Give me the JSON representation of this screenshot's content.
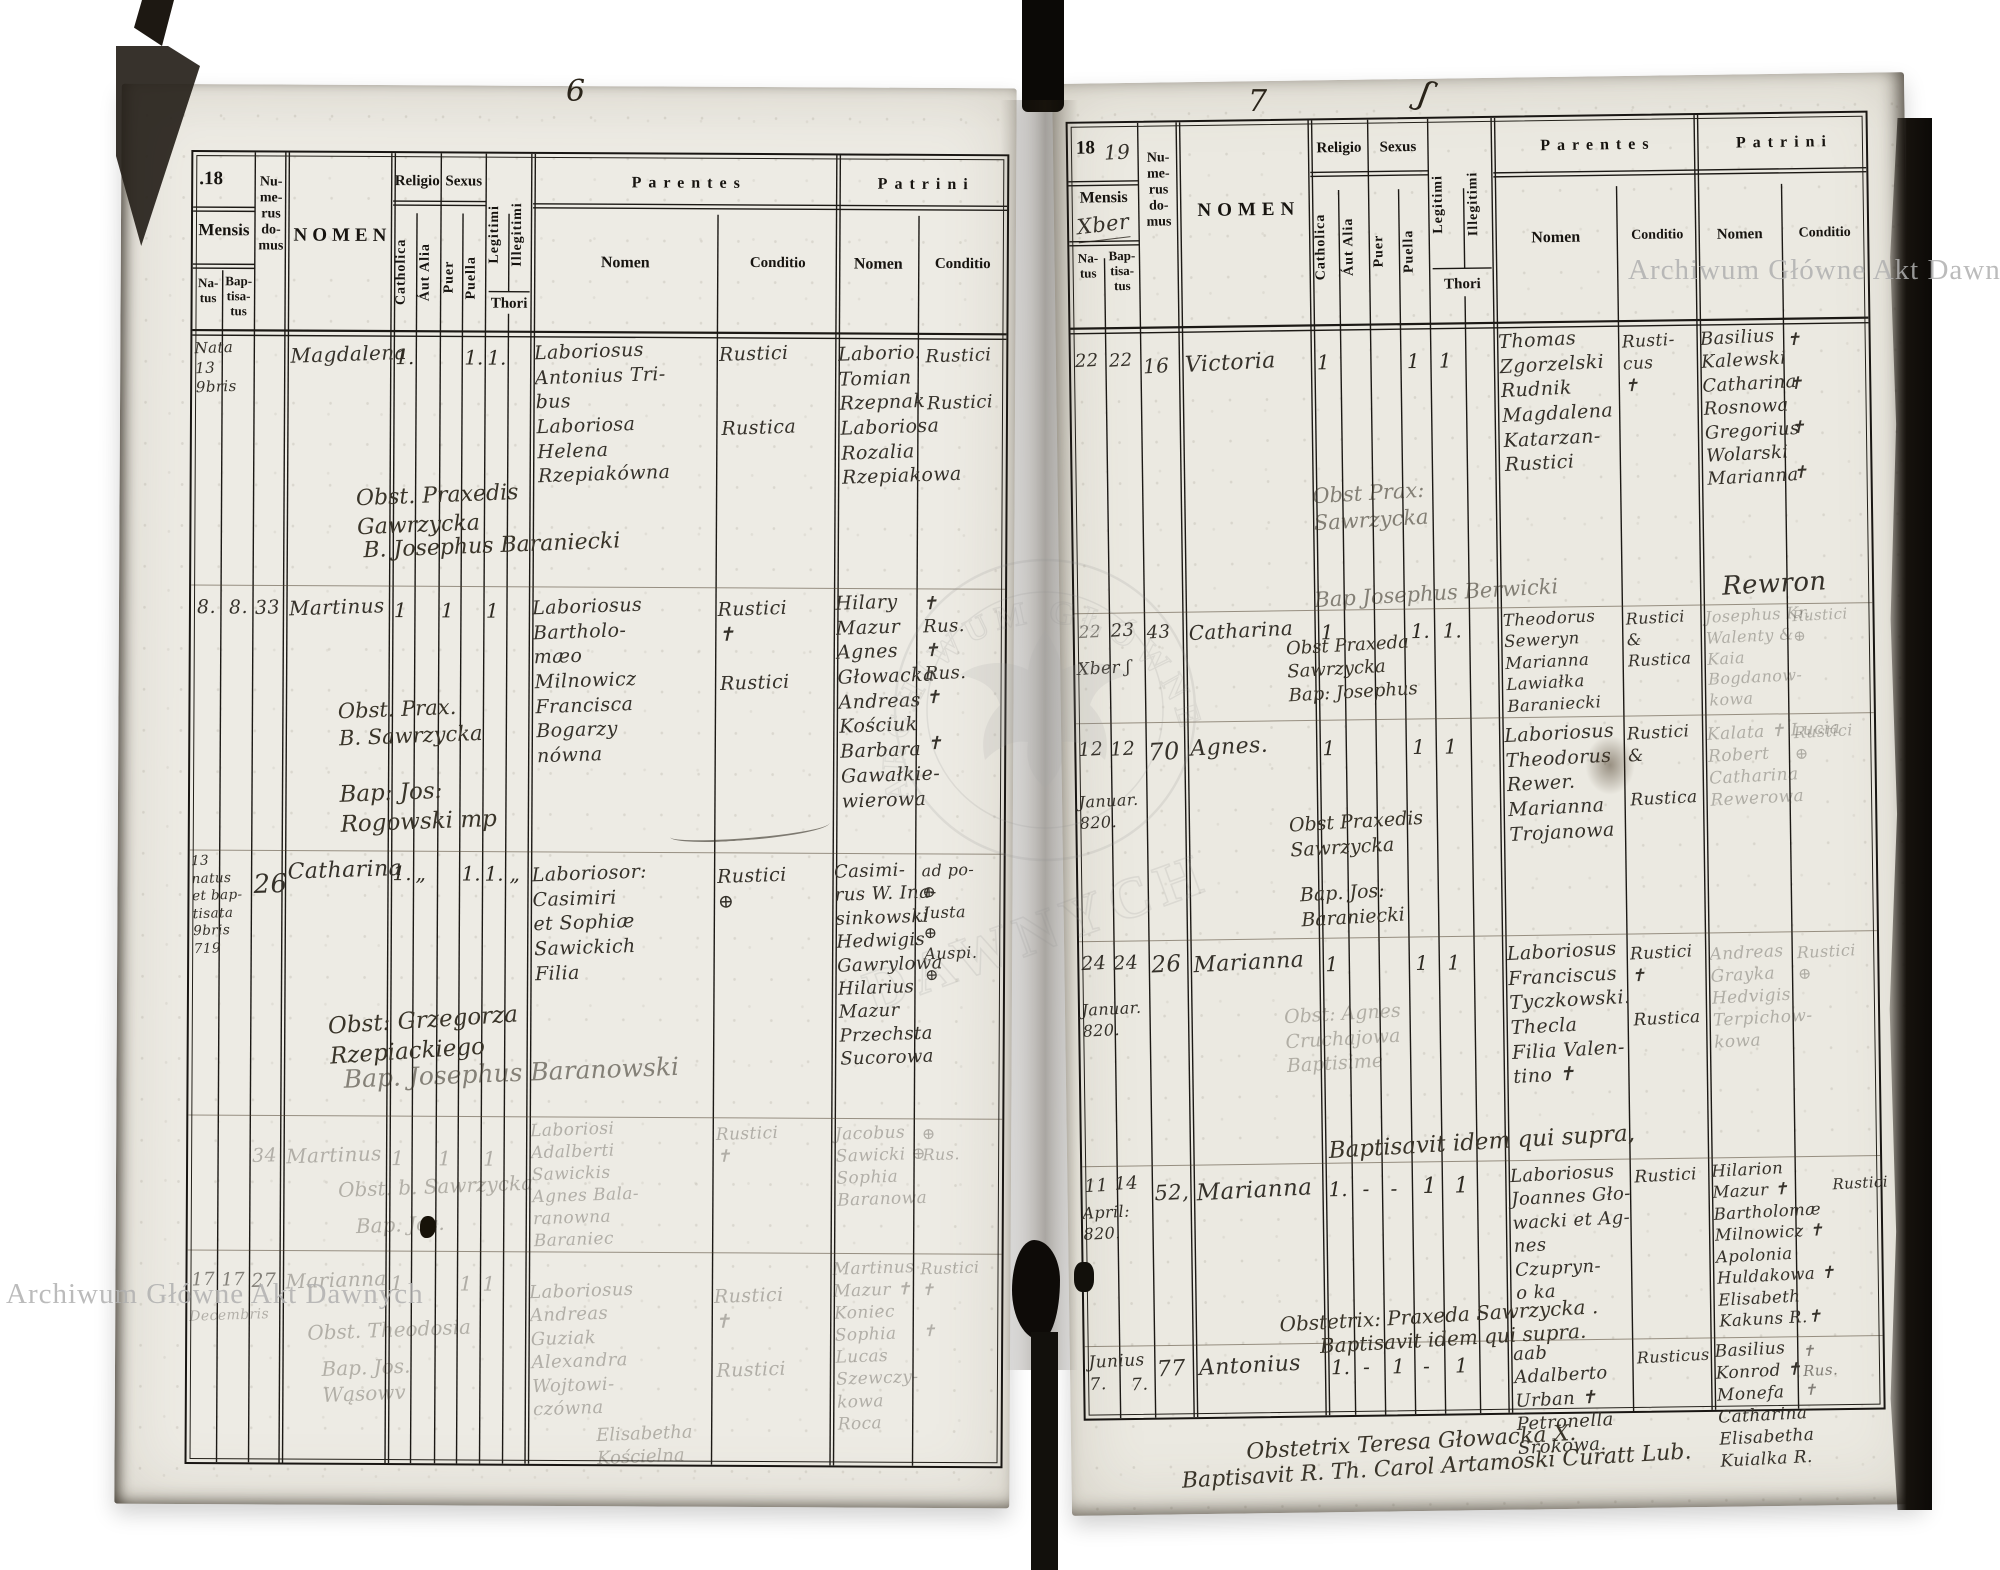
{
  "watermark": {
    "archive_name": "Archiwum Główne Akt Dawnych",
    "emblem_arc": "ARCHIWUM GŁÓWNE",
    "emblem_word": "DAWNYCH"
  },
  "form": {
    "year_prefix_dotted": ".18",
    "year_prefix": "18",
    "mensis": "Mensis",
    "natus": "Na-\ntus",
    "baptisatus": "Bap-\ntisa-\ntus",
    "numerus_domus": "Nu-\nme-\nrus\ndo-\nmus",
    "nomen": "NOMEN",
    "religio": "Religio",
    "catholica": "Catholica",
    "aut_alia": "Áut Alia",
    "sexus": "Sexus",
    "puer": "Puer",
    "puella": "Puella",
    "legitimi": "Legitimi",
    "illegitimi": "Illegitimi",
    "thori": "Thori",
    "parentes": "Parentes",
    "patrini": "Patrini",
    "sub_nomen": "Nomen",
    "sub_conditio": "Conditio"
  },
  "left_page": {
    "folio": "6",
    "entries": [
      {
        "natus": "Nata 13\n9bris",
        "nomen": "Magdalena",
        "m_cat": "1.",
        "m_pua": "1.",
        "m_leg": "1.",
        "par_nomen": "Laboriosus\nAntonius Tri-\nbus\nLaboriosa\nHelena\nRzepiakówna",
        "par_cond": "Rustici\n\n\nRustica",
        "pat_nomen": "Laborio.\nTomian\nRzepnak\nLaboriosa\nRozalia\nRzepiakowa",
        "pat_cond": "Rustici\n\nRustici",
        "note1": "Obst. Praxedis Gawrzycka",
        "note2": "B. Josephus Baraniecki"
      },
      {
        "natus": "8.",
        "baptisatus": "8.",
        "domus": "33",
        "nomen": "Martinus",
        "m_cat": "1",
        "m_pue": "1",
        "m_leg": "1",
        "par_nomen": "Laboriosus\nBartholo-\nmæo\nMilnowicz\nFrancisca\nBogarzy\nnówna",
        "par_cond": "Rustici\n✝\n\nRustici",
        "pat_nomen": "Hilary\nMazur\nAgnes\nGłowacka\nAndreas\nKościuk\nBarbara\nGawałkie-\nwierowa",
        "pat_cond": "✝\nRus.\n✝\nRus.\n✝\n\n✝",
        "note1": "Obst. Prax.\nB. Sawrzycka",
        "note2": "Bap: Jos:\nRogowski mp"
      },
      {
        "natus": "13\nnatus\net bap-\ntisata\n9bris\n719",
        "domus": "26",
        "nomen": "Catharina",
        "m_cat": "1.",
        "m_aut": "„",
        "m_pua": "1.",
        "m_leg": "1.",
        "m_ill": "„",
        "par_nomen": "Laboriosor:\nCasimiri\net Sophiæ\nSawickich\nFilia",
        "par_cond": "Rustici\n⊕",
        "pat_nomen": "Casimi-\nrus W. Ina-\nsinkowski\nHedwigis\nGawrylowa\nHilarius\nMazur\nPrzechsta\nSucorowa",
        "pat_cond": "ad po-\n⊕\nJusta\n⊕\nAuspi.\n⊕",
        "note1": "Obst: Grzegorza Rzepiackiego",
        "note2": "Bap. Josephus Baranowski"
      },
      {
        "domus": "34",
        "nomen": "Martinus",
        "m_cat": "1",
        "m_pue": "1",
        "m_leg": "1",
        "par_nomen": "Laboriosi\nAdalberti\nSawickis\nAgnes Bala-\nranowna\nBaraniec",
        "par_cond": "Rustici\n✝",
        "pat_nomen": "Jacobus\nSawicki ⊕\nSophia\nBaranowa",
        "pat_cond": "⊕\nRus.",
        "note1": "Obst. b. Sawrzycka",
        "note2": "Bap. Jos."
      },
      {
        "natus": "17",
        "baptisatus": "17",
        "domus": "27",
        "date_note": "Decembris",
        "nomen": "Marianna",
        "m_cat": "1",
        "m_pua": "1",
        "m_leg": "1",
        "par_nomen": "Laboriosus\nAndreas\nGuziak\nAlexandra\nWojtowi-\nczówna",
        "par_cond": "Rustici\n✝\n\nRustici",
        "pat_nomen": "Martinus\nMazur ✝\nKoniec\nSophia\nLucas\nSzewczy-\nkowa\nRoca",
        "pat_cond": "Rustici\n✝\n\n✝",
        "note1": "Obst. Theodosia",
        "note2": "Bap. Jos.\nWąsowv",
        "trailing": "Elisabetha\nKościelna"
      }
    ]
  },
  "right_page": {
    "folio": "7",
    "folio_mark": "ʃ",
    "year_hand": "19",
    "mensis_hand": "Xber",
    "entries": [
      {
        "natus": "22",
        "baptisatus": "22",
        "domus": "16",
        "nomen": "Victoria",
        "m_cat": "1",
        "m_pua": "1",
        "m_leg": "1",
        "par_nomen": "Thomas\nZgorzelski\nRudnik\nMagdalena\nKatarzan-\nRustici",
        "par_cond": "Rusti-\ncus\n✝",
        "pat_nomen": "Basilius\nKalewski\nCatharina\nRosnowa\nGregorius\nWolarski\nMarianna",
        "pat_cond": "✝\n\n✝\n\n✝\n\n✝",
        "note1": "Obst Prax:\nSawrzycka",
        "note2": "Bap Josephus Berwicki",
        "signature": "Rewron"
      },
      {
        "natus": "22",
        "baptisatus": "23",
        "domus": "43",
        "date_note": "Xber ʃ",
        "nomen": "Catharina",
        "m_cat": "1",
        "m_pua": "1.",
        "m_leg": "1.",
        "par_nomen": "Theodorus\nSeweryn\nMarianna\nLawiałka\nBaraniecki",
        "par_cond": "Rustici\n&\nRustica",
        "pat_nomen": "Josephus Kr.\nWalenty &\nKaia\nBogdanow-\nkowa",
        "pat_cond": "Rustici\n⊕",
        "note1": "Obst Praxeda\nSawrzycka\nBap: Josephus"
      },
      {
        "natus": "12",
        "baptisatus": "12",
        "domus": "70",
        "date_note": "Januar.\n820.",
        "nomen": "Agnes.",
        "m_cat": "1",
        "m_pua": "1",
        "m_leg": "1",
        "par_nomen": "Laboriosus\nTheodorus\nRewer.\nMarianna\nTrojanowa",
        "par_cond": "Rustici\n&\n\nRustica",
        "pat_nomen": "Kalata ✝ Lucia\nRobert\nCatharina\nRewerowa",
        "pat_cond": "Rustici\n⊕",
        "note1": "Obst Praxedis\nSawrzycka",
        "note2": "Bap. Jos:\nBaraniecki"
      },
      {
        "natus": "24",
        "baptisatus": "24",
        "domus": "26",
        "date_note": "Januar.\n820.",
        "nomen": "Marianna",
        "m_cat": "1",
        "m_pua": "1",
        "m_leg": "1",
        "par_nomen": "Laboriosus\nFranciscus\nTyczkowski.\nThecla\nFilia Valen-\ntino ✝",
        "par_cond": "Rustici\n✝\n\nRustica",
        "pat_nomen": "Andreas\nGrayka\nHedvigis\nTerpichow-\nkowa",
        "pat_cond": "Rustici\n⊕",
        "note1": "Obst: Agnes\nCruchajowa\nBaptisime",
        "centered_note": "Baptisavit idem qui supra,"
      },
      {
        "natus": "11",
        "baptisatus": "14",
        "domus": "52,",
        "date_note": "April:\n820.",
        "nomen": "Marianna",
        "m_cat": "1.",
        "m_aut": "-",
        "m_pue": "-",
        "m_pua": "1",
        "m_leg": "1",
        "par_nomen": "Laboriosus\nJoannes Gło-\nwacki et Ag-\nnes Czupryn-\no ka",
        "par_cond": "Rustici",
        "pat_nomen": "Hilarion\nMazur ✝\nBartholomæ\nMilnowicz ✝\nApolonia\nHuldakowa ✝\nElisabeth\nKakuns R.✝",
        "pat_cond": "Rustici",
        "note_obst": "Obstetrix: Praxeda Sawrzycka .",
        "note_bap": "Baptisavit idem qui supra."
      },
      {
        "natus": "Junius\n7.",
        "baptisatus": "7.",
        "domus": "77",
        "nomen": "Antonius",
        "m_cat": "1.",
        "m_aut": "-",
        "m_pue": "1",
        "m_pua": "-",
        "m_leg": "1",
        "par_nomen": "aab Adalberto\nUrban ✝\nPetronella\nSrokowa.",
        "par_cond": "Rusticus",
        "pat_nomen": "Basilius\nKonrod ✝\nMonefa\nCatharina\nElisabetha\nKuialka R.",
        "pat_cond": "✝\nRus.\n✝",
        "note_obst": "Obstetrix Teresa Głowacka X.",
        "note_bap": "Baptisavit R. Th. Carol Artamoski Curatt Lub."
      }
    ]
  }
}
